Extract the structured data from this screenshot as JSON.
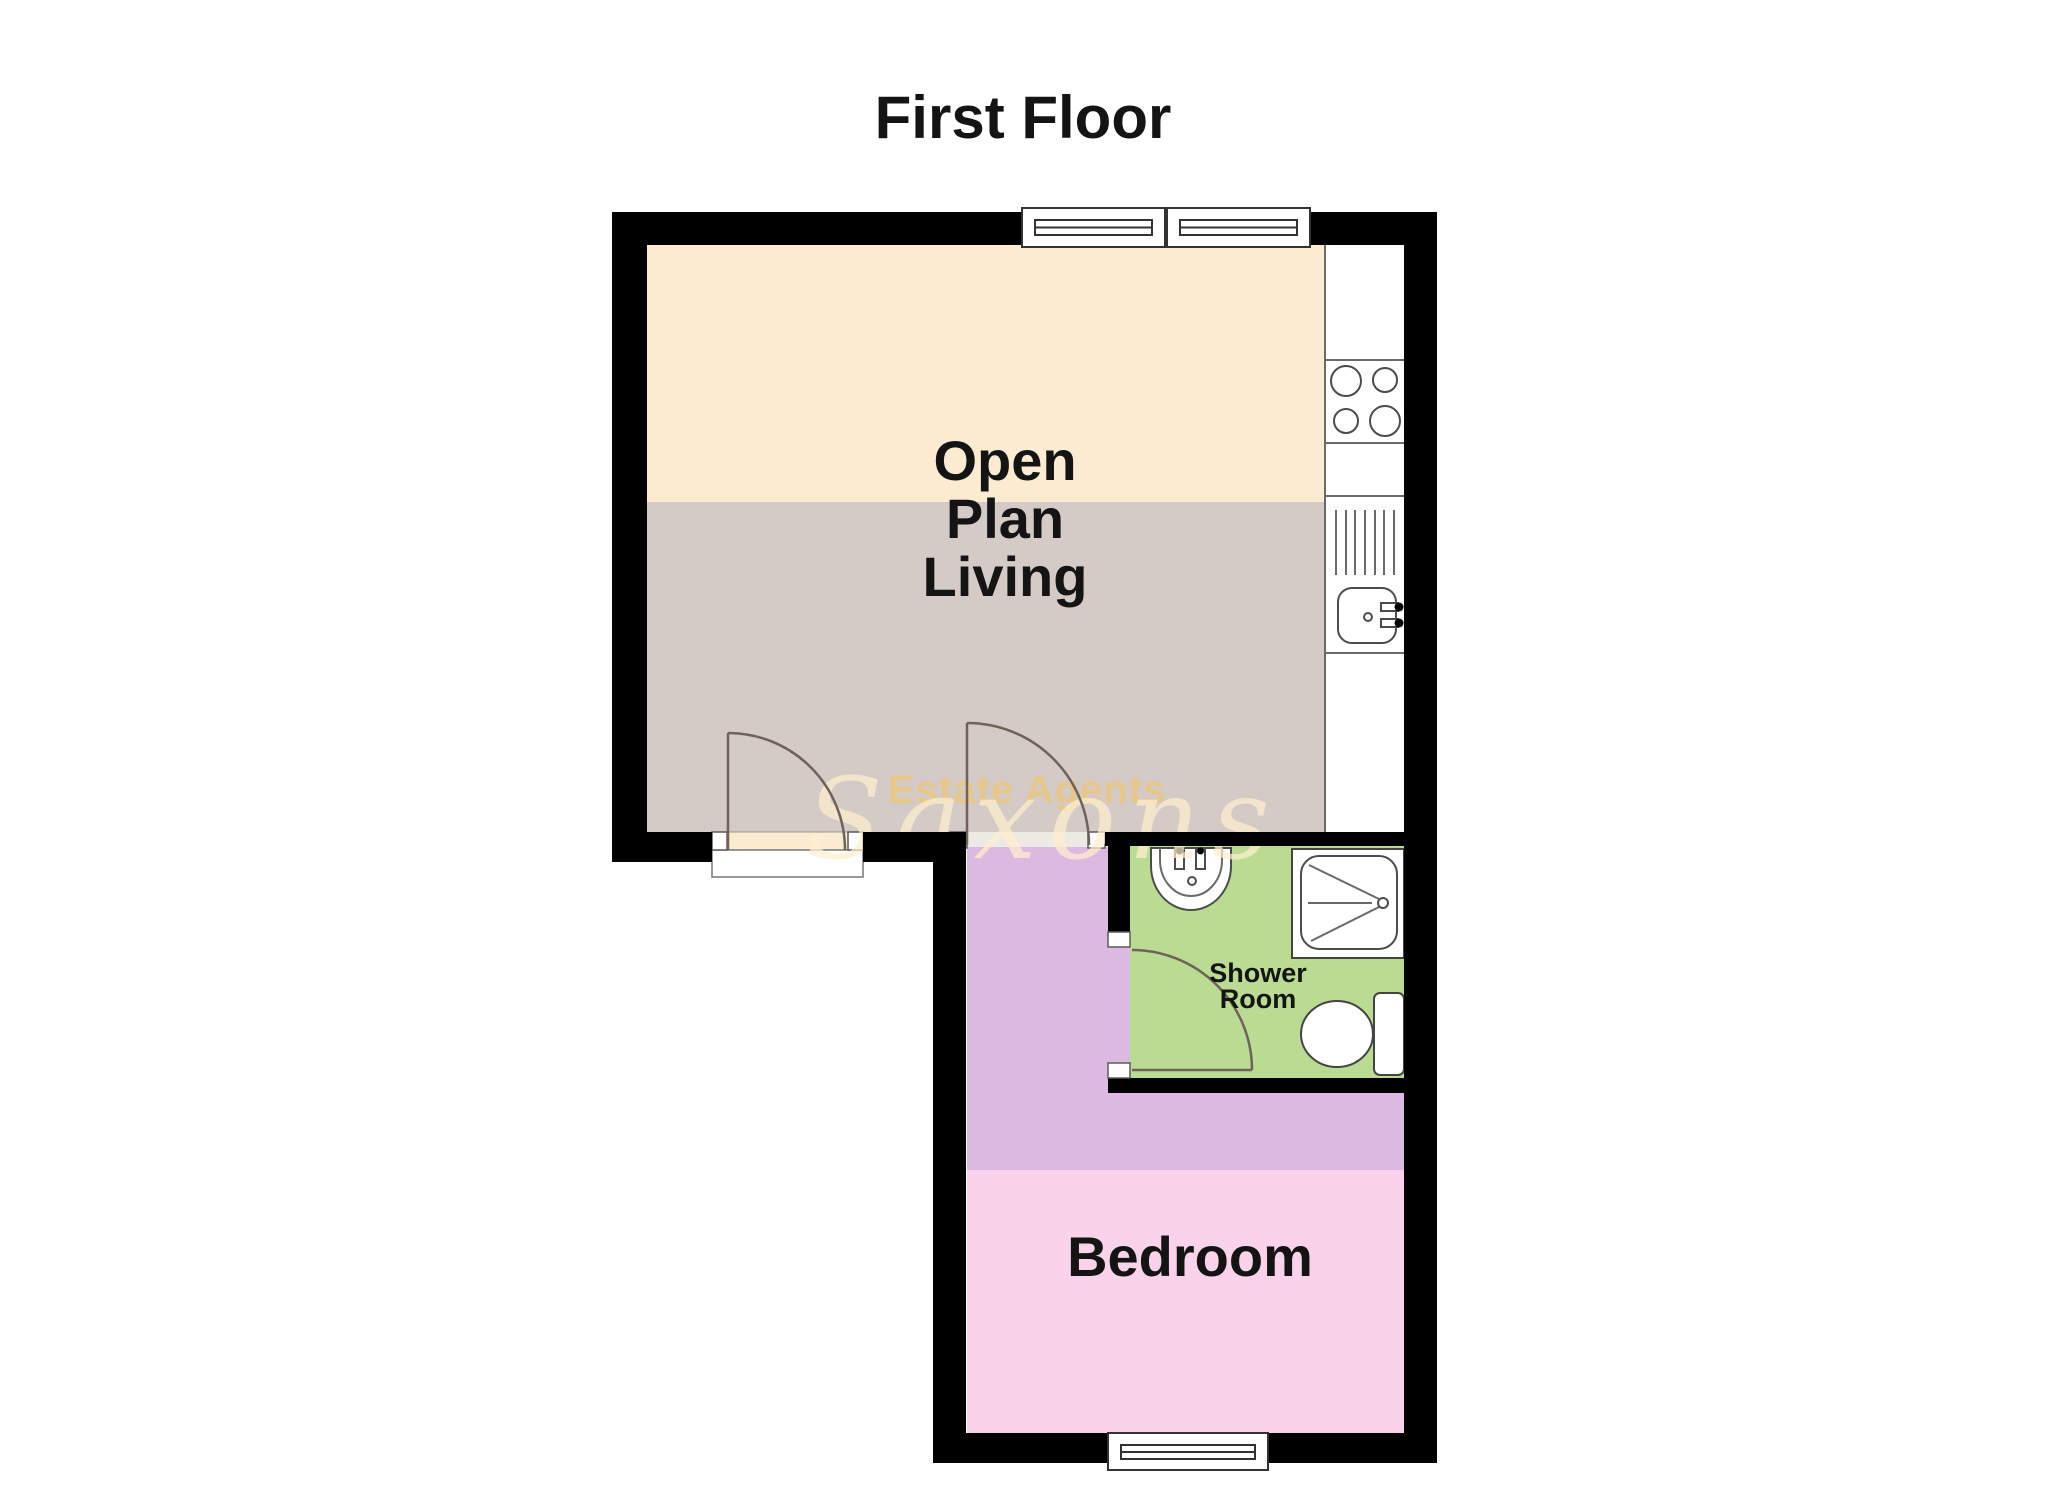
{
  "title": "First Floor",
  "watermark": {
    "tagline": "Estate Agents",
    "brand_script": "Saxons"
  },
  "rooms": {
    "open_plan_living": {
      "label_lines": [
        "Open",
        "Plan",
        "Living"
      ]
    },
    "shower_room": {
      "label_lines": [
        "Shower",
        "Room"
      ]
    },
    "bedroom": {
      "label": "Bedroom"
    }
  },
  "fixtures": {
    "kitchen": [
      "hob-icon",
      "drainer-icon",
      "kitchen-sink-icon"
    ],
    "shower_room": [
      "basin-icon",
      "shower-tray-icon",
      "toilet-icon"
    ]
  },
  "colors": {
    "wall": "#000000",
    "living_floor_upper": "#FAEBD1",
    "living_floor_lower": "#D4CBC6",
    "kitchen_floor": "#FFFFFF",
    "hallway_floor": "#DCB9E0",
    "bedroom_floor": "#FAD2EA",
    "shower_floor": "#B9DC92",
    "doorway_strip": "#EDE9E3",
    "label_text": "#141414",
    "watermark_script": "rgba(255,238,205,0.72)",
    "watermark_tagline": "rgba(243,197,107,0.65)"
  }
}
